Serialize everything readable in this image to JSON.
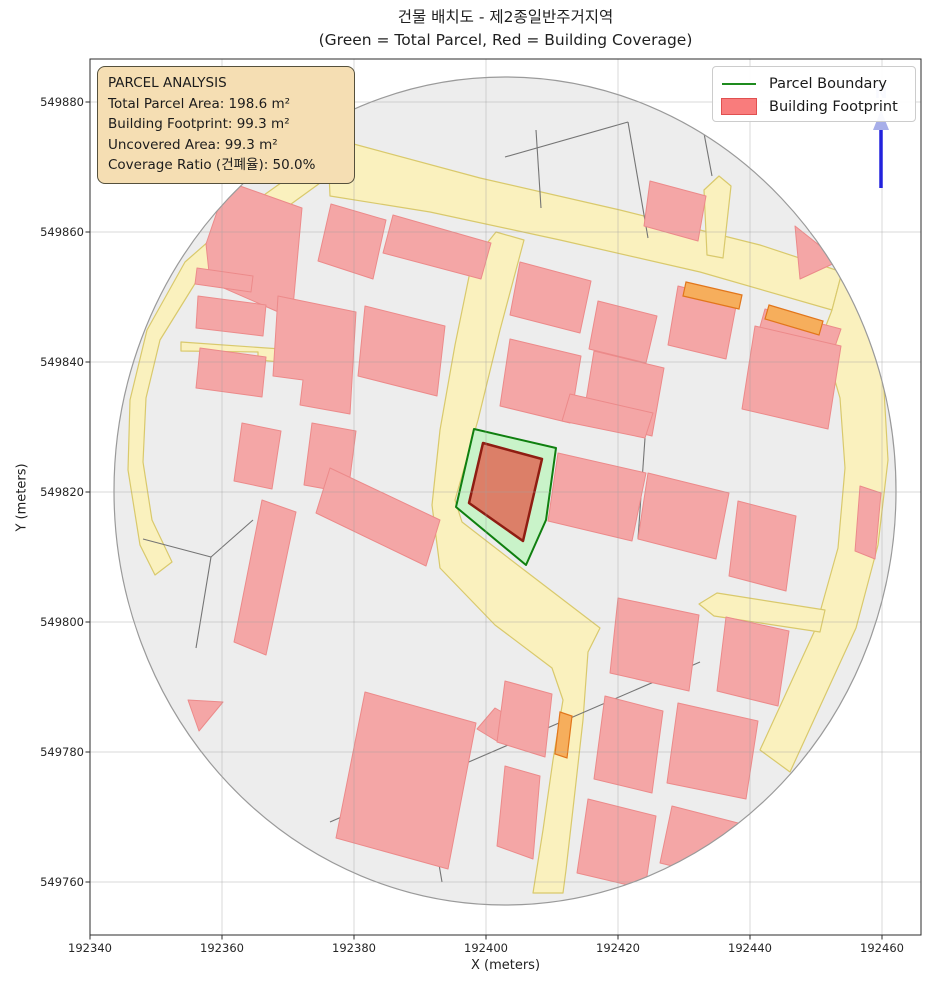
{
  "title": {
    "line1": "건물 배치도 - 제2종일반주거지역",
    "line2": "(Green = Total Parcel, Red = Building Coverage)"
  },
  "axes": {
    "x_label": "X (meters)",
    "y_label": "Y (meters)",
    "plot": {
      "left": 90,
      "top": 59,
      "right": 921,
      "bottom": 935
    },
    "x_ticks": [
      {
        "label": "192340",
        "px": 90
      },
      {
        "label": "192360",
        "px": 222
      },
      {
        "label": "192380",
        "px": 354
      },
      {
        "label": "192400",
        "px": 486
      },
      {
        "label": "192420",
        "px": 618
      },
      {
        "label": "192440",
        "px": 750
      },
      {
        "label": "192460",
        "px": 882
      }
    ],
    "y_ticks": [
      {
        "label": "549880",
        "px": 102
      },
      {
        "label": "549860",
        "px": 232
      },
      {
        "label": "549840",
        "px": 362
      },
      {
        "label": "549820",
        "px": 492
      },
      {
        "label": "549800",
        "px": 622
      },
      {
        "label": "549780",
        "px": 752
      },
      {
        "label": "549760",
        "px": 882
      }
    ]
  },
  "legend": {
    "items": [
      {
        "label": "Parcel Boundary",
        "type": "line"
      },
      {
        "label": "Building Footprint",
        "type": "patch"
      }
    ]
  },
  "info_box": {
    "lines": [
      "PARCEL ANALYSIS",
      "Total Parcel Area: 198.6 m²",
      "Building Footprint: 99.3 m²",
      "Uncovered Area: 99.3 m²",
      "Coverage Ratio (건폐율): 50.0%"
    ]
  },
  "north": {
    "label": "N"
  },
  "colors": {
    "base": "#EDEDED",
    "base_stroke": "#9A9A9A",
    "road_fill": "#FAF1BE",
    "road_stroke": "#D9C96C",
    "accent_fill": "#F6AE5C",
    "accent_stroke": "#E2761B",
    "building_fill": "#F4A6A6",
    "building_stroke": "#EC8A8A",
    "parcel_line": "#757575",
    "parcel_fill": "#C9F3C9",
    "parcel_stroke": "#0F7F0F",
    "main_building_fill": "#DC7F68",
    "main_building_stroke": "#8F1D12",
    "north_line": "#2222DD",
    "north_accent": "#A7AEE9",
    "grid": "rgba(160,160,160,0.4)",
    "axis": "#2B2B2B"
  },
  "map": {
    "boundary": {
      "cx": 505,
      "cy": 491,
      "rx": 391,
      "ry": 414
    },
    "roads": [
      [
        [
          328,
          150
        ],
        [
          350,
          143
        ],
        [
          480,
          178
        ],
        [
          620,
          210
        ],
        [
          760,
          245
        ],
        [
          842,
          272
        ],
        [
          832,
          310
        ],
        [
          700,
          272
        ],
        [
          560,
          240
        ],
        [
          430,
          212
        ],
        [
          330,
          196
        ]
      ],
      [
        [
          842,
          272
        ],
        [
          868,
          320
        ],
        [
          884,
          390
        ],
        [
          888,
          460
        ],
        [
          878,
          545
        ],
        [
          856,
          628
        ],
        [
          790,
          772
        ],
        [
          760,
          750
        ],
        [
          815,
          630
        ],
        [
          838,
          548
        ],
        [
          845,
          468
        ],
        [
          840,
          398
        ],
        [
          822,
          336
        ],
        [
          832,
          310
        ]
      ],
      [
        [
          496,
          232
        ],
        [
          524,
          240
        ],
        [
          500,
          330
        ],
        [
          478,
          420
        ],
        [
          455,
          500
        ],
        [
          462,
          522
        ],
        [
          515,
          563
        ],
        [
          600,
          628
        ],
        [
          588,
          652
        ],
        [
          583,
          720
        ],
        [
          574,
          800
        ],
        [
          566,
          870
        ],
        [
          563,
          893
        ],
        [
          533,
          893
        ],
        [
          543,
          830
        ],
        [
          553,
          760
        ],
        [
          563,
          700
        ],
        [
          552,
          668
        ],
        [
          495,
          625
        ],
        [
          440,
          568
        ],
        [
          432,
          505
        ],
        [
          440,
          430
        ],
        [
          455,
          345
        ],
        [
          472,
          262
        ]
      ],
      [
        [
          330,
          148
        ],
        [
          250,
          205
        ],
        [
          185,
          262
        ],
        [
          147,
          330
        ],
        [
          130,
          400
        ],
        [
          128,
          470
        ],
        [
          140,
          545
        ],
        [
          155,
          575
        ],
        [
          172,
          562
        ],
        [
          152,
          520
        ],
        [
          143,
          462
        ],
        [
          146,
          398
        ],
        [
          160,
          340
        ],
        [
          196,
          282
        ],
        [
          258,
          228
        ],
        [
          338,
          170
        ]
      ],
      [
        [
          181,
          342
        ],
        [
          281,
          349
        ],
        [
          281,
          362
        ],
        [
          258,
          360
        ],
        [
          258,
          352
        ],
        [
          181,
          351
        ]
      ],
      [
        [
          699,
          604
        ],
        [
          717,
          593
        ],
        [
          825,
          610
        ],
        [
          820,
          632
        ],
        [
          714,
          616
        ]
      ],
      [
        [
          704,
          190
        ],
        [
          719,
          176
        ],
        [
          731,
          186
        ],
        [
          723,
          258
        ],
        [
          707,
          255
        ]
      ]
    ],
    "accents": [
      [
        [
          686,
          282
        ],
        [
          742,
          295
        ],
        [
          739,
          309
        ],
        [
          683,
          296
        ]
      ],
      [
        [
          769,
          305
        ],
        [
          823,
          321
        ],
        [
          819,
          335
        ],
        [
          765,
          319
        ]
      ],
      [
        [
          560,
          712
        ],
        [
          572,
          716
        ],
        [
          567,
          758
        ],
        [
          555,
          754
        ]
      ]
    ],
    "buildings": [
      [
        [
          240,
          186
        ],
        [
          302,
          208
        ],
        [
          292,
          318
        ],
        [
          210,
          282
        ],
        [
          206,
          244
        ],
        [
          219,
          206
        ]
      ],
      [
        [
          331,
          204
        ],
        [
          386,
          220
        ],
        [
          373,
          279
        ],
        [
          318,
          261
        ]
      ],
      [
        [
          393,
          215
        ],
        [
          491,
          243
        ],
        [
          481,
          279
        ],
        [
          383,
          253
        ]
      ],
      [
        [
          650,
          181
        ],
        [
          706,
          196
        ],
        [
          698,
          241
        ],
        [
          644,
          226
        ]
      ],
      [
        [
          197,
          268
        ],
        [
          253,
          276
        ],
        [
          251,
          292
        ],
        [
          195,
          284
        ]
      ],
      [
        [
          198,
          296
        ],
        [
          266,
          305
        ],
        [
          263,
          336
        ],
        [
          196,
          328
        ]
      ],
      [
        [
          200,
          348
        ],
        [
          266,
          357
        ],
        [
          262,
          397
        ],
        [
          196,
          388
        ]
      ],
      [
        [
          278,
          296
        ],
        [
          356,
          312
        ],
        [
          350,
          414
        ],
        [
          300,
          405
        ],
        [
          303,
          380
        ],
        [
          273,
          376
        ]
      ],
      [
        [
          365,
          306
        ],
        [
          445,
          326
        ],
        [
          437,
          396
        ],
        [
          358,
          376
        ]
      ],
      [
        [
          242,
          423
        ],
        [
          281,
          431
        ],
        [
          272,
          489
        ],
        [
          234,
          481
        ]
      ],
      [
        [
          312,
          423
        ],
        [
          356,
          431
        ],
        [
          348,
          493
        ],
        [
          304,
          485
        ]
      ],
      [
        [
          262,
          500
        ],
        [
          296,
          512
        ],
        [
          266,
          655
        ],
        [
          234,
          642
        ]
      ],
      [
        [
          330,
          468
        ],
        [
          440,
          520
        ],
        [
          426,
          566
        ],
        [
          316,
          513
        ]
      ],
      [
        [
          495,
          708
        ],
        [
          519,
          722
        ],
        [
          500,
          743
        ],
        [
          477,
          729
        ]
      ],
      [
        [
          365,
          692
        ],
        [
          476,
          723
        ],
        [
          448,
          869
        ],
        [
          336,
          838
        ]
      ],
      [
        [
          188,
          700
        ],
        [
          223,
          702
        ],
        [
          199,
          731
        ]
      ],
      [
        [
          520,
          262
        ],
        [
          591,
          281
        ],
        [
          580,
          333
        ],
        [
          510,
          315
        ]
      ],
      [
        [
          598,
          301
        ],
        [
          657,
          316
        ],
        [
          646,
          363
        ],
        [
          589,
          349
        ]
      ],
      [
        [
          678,
          286
        ],
        [
          737,
          301
        ],
        [
          726,
          359
        ],
        [
          668,
          345
        ]
      ],
      [
        [
          765,
          309
        ],
        [
          841,
          329
        ],
        [
          830,
          361
        ],
        [
          756,
          341
        ]
      ],
      [
        [
          510,
          339
        ],
        [
          581,
          356
        ],
        [
          570,
          423
        ],
        [
          500,
          406
        ]
      ],
      [
        [
          594,
          351
        ],
        [
          664,
          368
        ],
        [
          652,
          436
        ],
        [
          583,
          419
        ]
      ],
      [
        [
          755,
          326
        ],
        [
          841,
          346
        ],
        [
          828,
          429
        ],
        [
          742,
          409
        ]
      ],
      [
        [
          570,
          394
        ],
        [
          653,
          413
        ],
        [
          645,
          438
        ],
        [
          562,
          421
        ]
      ],
      [
        [
          558,
          453
        ],
        [
          646,
          473
        ],
        [
          632,
          541
        ],
        [
          548,
          521
        ]
      ],
      [
        [
          648,
          473
        ],
        [
          729,
          493
        ],
        [
          716,
          559
        ],
        [
          638,
          539
        ]
      ],
      [
        [
          738,
          501
        ],
        [
          796,
          516
        ],
        [
          786,
          591
        ],
        [
          729,
          576
        ]
      ],
      [
        [
          618,
          598
        ],
        [
          699,
          615
        ],
        [
          689,
          691
        ],
        [
          610,
          673
        ]
      ],
      [
        [
          726,
          617
        ],
        [
          789,
          631
        ],
        [
          778,
          706
        ],
        [
          717,
          691
        ]
      ],
      [
        [
          605,
          696
        ],
        [
          663,
          711
        ],
        [
          652,
          793
        ],
        [
          594,
          779
        ]
      ],
      [
        [
          678,
          703
        ],
        [
          758,
          721
        ],
        [
          746,
          799
        ],
        [
          667,
          783
        ]
      ],
      [
        [
          588,
          799
        ],
        [
          656,
          816
        ],
        [
          645,
          889
        ],
        [
          577,
          873
        ]
      ],
      [
        [
          672,
          806
        ],
        [
          738,
          823
        ],
        [
          726,
          879
        ],
        [
          660,
          863
        ]
      ],
      [
        [
          505,
          681
        ],
        [
          552,
          694
        ],
        [
          545,
          757
        ],
        [
          497,
          742
        ]
      ],
      [
        [
          505,
          766
        ],
        [
          540,
          776
        ],
        [
          533,
          859
        ],
        [
          497,
          846
        ]
      ],
      [
        [
          860,
          486
        ],
        [
          881,
          493
        ],
        [
          875,
          559
        ],
        [
          855,
          551
        ]
      ],
      [
        [
          795,
          226
        ],
        [
          839,
          261
        ],
        [
          800,
          279
        ]
      ]
    ],
    "parcel_lines": [
      [
        [
          536,
          130
        ],
        [
          541,
          208
        ]
      ],
      [
        [
          628,
          122
        ],
        [
          648,
          238
        ]
      ],
      [
        [
          505,
          157
        ],
        [
          628,
          122
        ]
      ],
      [
        [
          700,
          112
        ],
        [
          712,
          176
        ]
      ],
      [
        [
          143,
          539
        ],
        [
          211,
          557
        ],
        [
          196,
          648
        ]
      ],
      [
        [
          253,
          520
        ],
        [
          211,
          557
        ]
      ],
      [
        [
          330,
          822
        ],
        [
          700,
          662
        ]
      ],
      [
        [
          420,
          753
        ],
        [
          442,
          882
        ]
      ],
      [
        [
          281,
          353
        ],
        [
          340,
          362
        ]
      ],
      [
        [
          645,
          438
        ],
        [
          638,
          539
        ]
      ]
    ],
    "parcel": [
      [
        474,
        429
      ],
      [
        556,
        448
      ],
      [
        546,
        520
      ],
      [
        526,
        565
      ],
      [
        456,
        507
      ]
    ],
    "main_building": [
      [
        483,
        443
      ],
      [
        542,
        459
      ],
      [
        523,
        541
      ],
      [
        469,
        503
      ]
    ]
  }
}
